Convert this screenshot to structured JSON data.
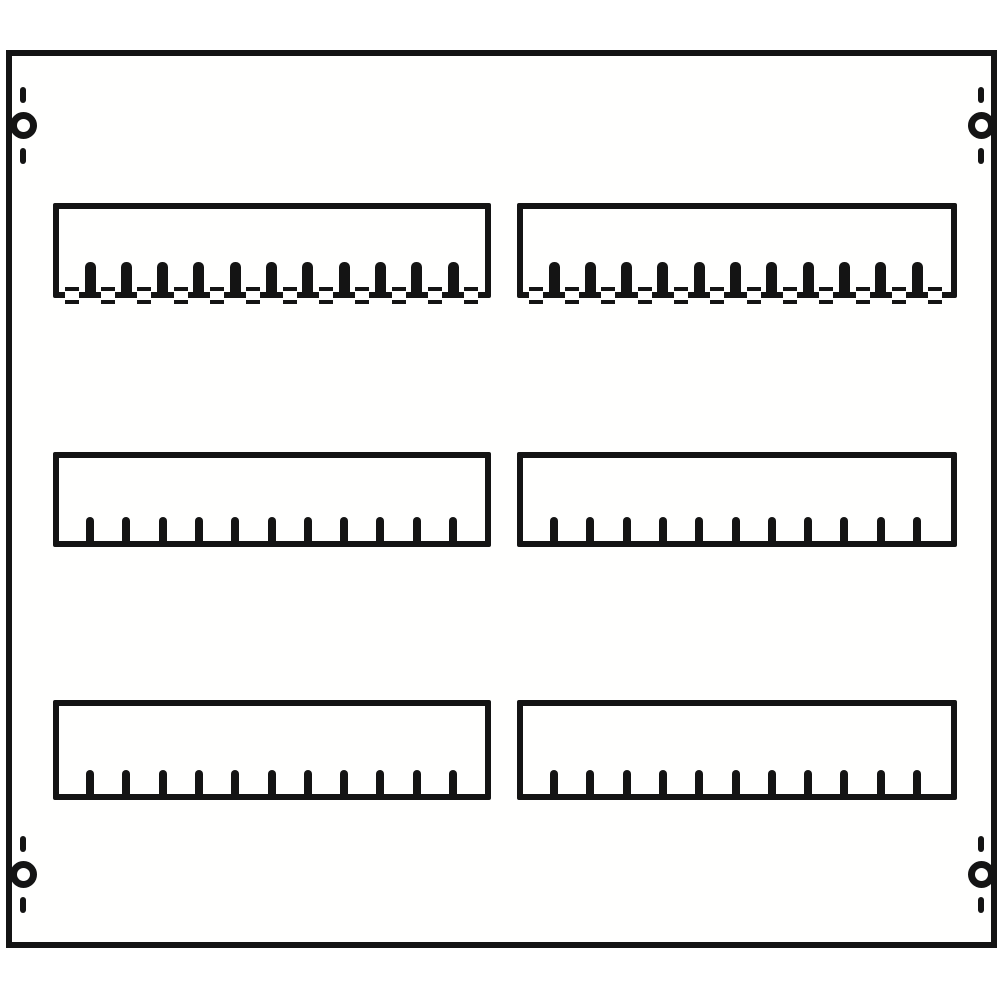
{
  "drawing": {
    "description": "black-and-white technical line drawing of a modular distribution board front panel with six DIN-module cutout strips (2 columns x 3 rows) and four corner mounting holes",
    "background_color": "#ffffff",
    "line_color": "#141414",
    "panel_fill_color": "#fffffe"
  },
  "panel": {
    "x": 6,
    "y": 50,
    "width": 991,
    "height": 898,
    "stroke": 6
  },
  "mounting_holes": {
    "outer_diameter": 27,
    "ring_stroke": 7,
    "dash_width": 6,
    "dash_height": 16,
    "dash_gap": 9,
    "positions": [
      {
        "cx": 23,
        "cy": 125
      },
      {
        "cx": 981,
        "cy": 125
      },
      {
        "cx": 23,
        "cy": 874
      },
      {
        "cx": 981,
        "cy": 874
      }
    ]
  },
  "slots": {
    "stroke": 6,
    "columns": [
      {
        "x": 53,
        "width": 438
      },
      {
        "x": 517,
        "width": 440
      }
    ],
    "rows": [
      {
        "y": 203,
        "height": 95,
        "style": "clipped"
      },
      {
        "y": 452,
        "height": 95,
        "style": "plain"
      },
      {
        "y": 700,
        "height": 100,
        "style": "plain"
      }
    ],
    "teeth": {
      "count": 11,
      "first_center": 37,
      "pitch": 36.3,
      "clipped": {
        "width": 11,
        "height": 36,
        "radius": 5
      },
      "plain": {
        "width": 8,
        "height": 30,
        "radius": 4
      }
    },
    "clips": {
      "count": 12,
      "first_center": 18.85,
      "pitch": 36.3,
      "width": 14,
      "height": 17,
      "bar": 4
    }
  }
}
